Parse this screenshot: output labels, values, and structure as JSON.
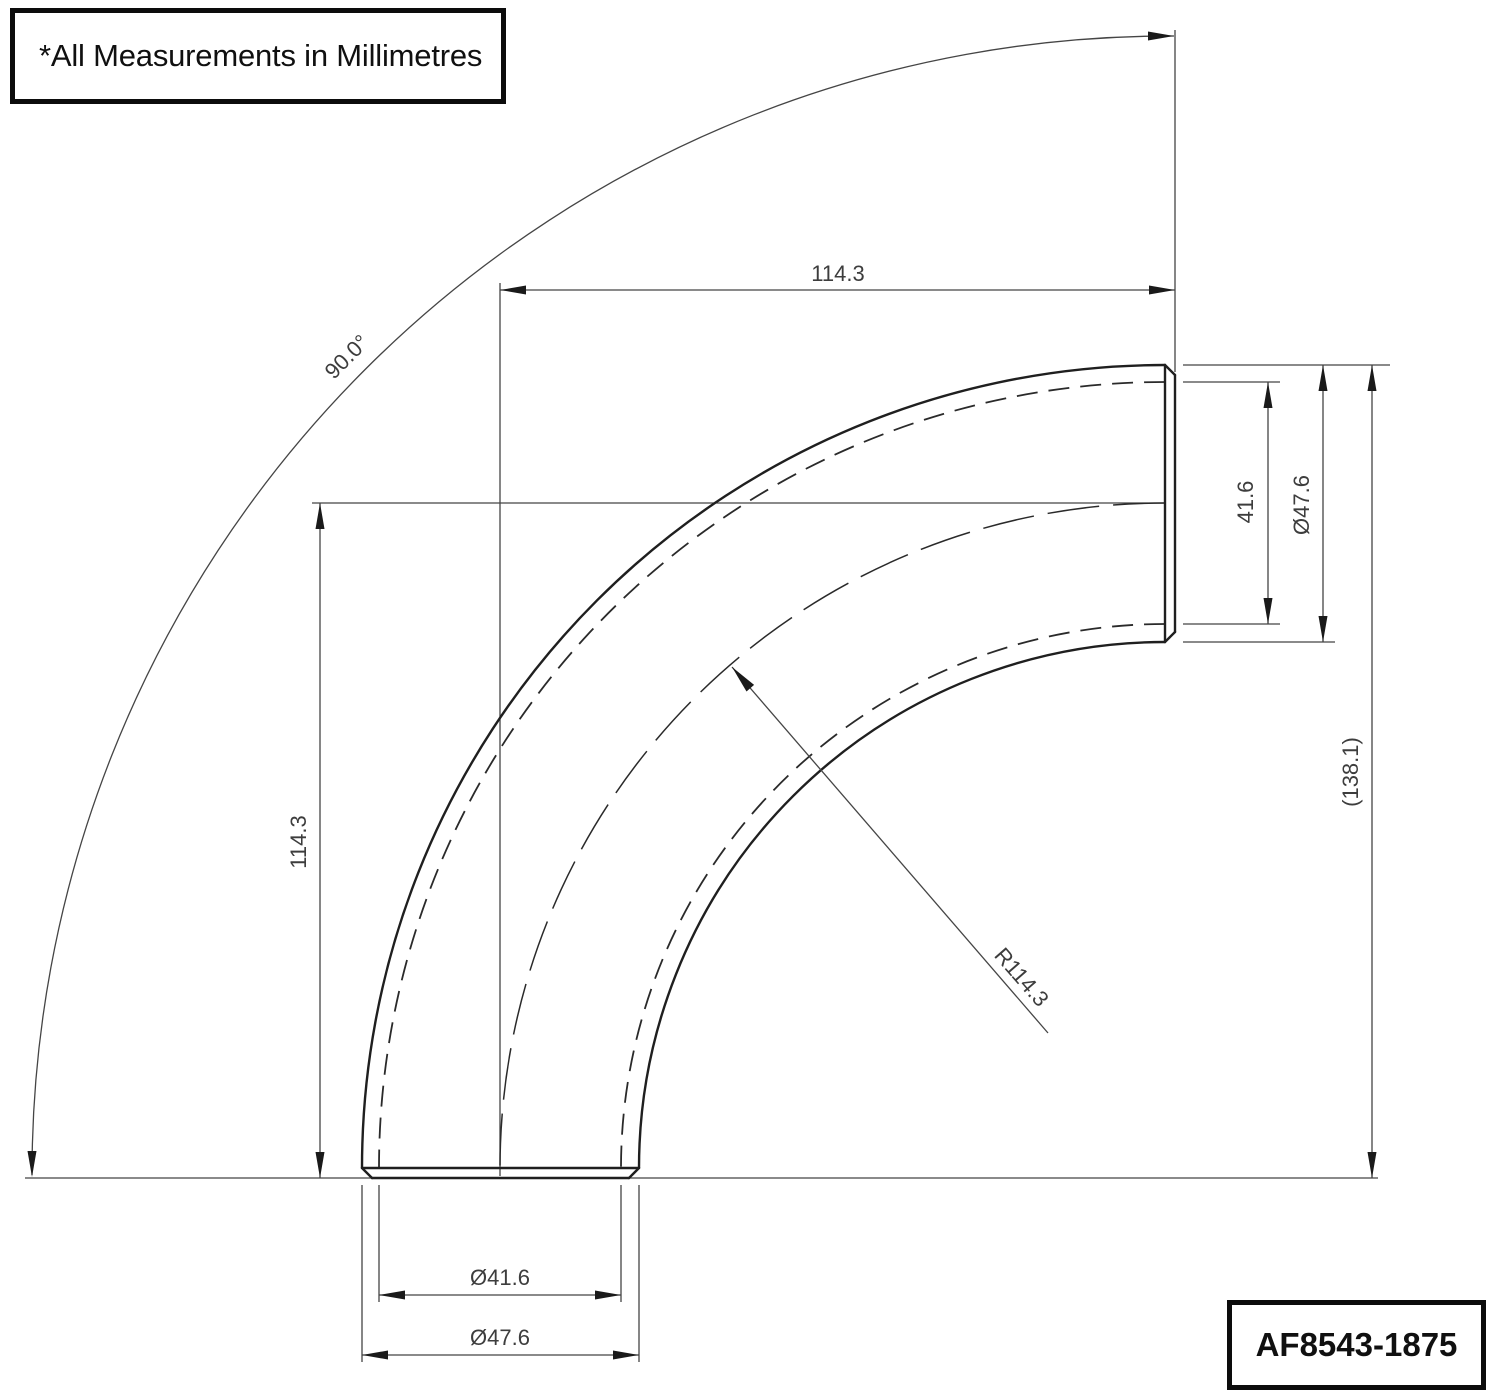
{
  "drawing": {
    "note": "*All Measurements in Millimetres",
    "part_number": "AF8543-1875"
  },
  "dimensions": {
    "top_length": "114.3",
    "left_length": "114.3",
    "bend_angle": "90.0°",
    "bend_radius": "R114.3",
    "port_inner_diameter": "41.6",
    "port_outer_diameter": "Ø47.6",
    "overall_height_ref": "(138.1)",
    "bottom_inner_diameter": "Ø41.6",
    "bottom_outer_diameter": "Ø47.6"
  },
  "colors": {
    "background": "#ffffff",
    "pipe_line": "#1f1f1f",
    "dimension_line": "#454545",
    "dimension_text": "#3d3d3d",
    "border": "#0c0c0c"
  }
}
